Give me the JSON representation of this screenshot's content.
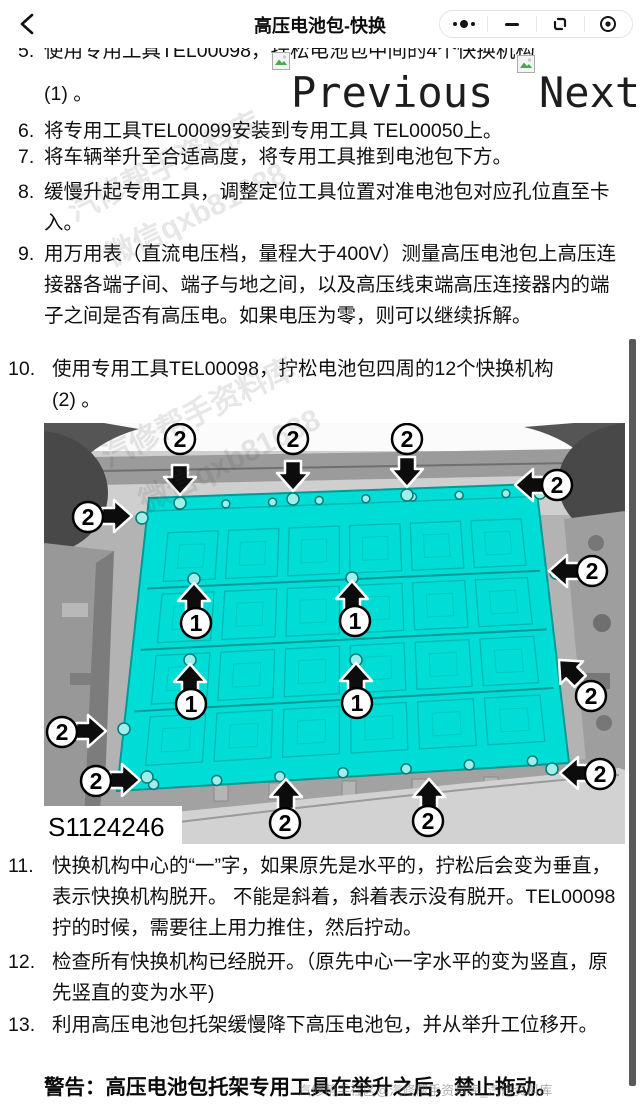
{
  "header": {
    "title": "高压电池包-快换",
    "back_icon": "chevron-left",
    "capsule_icons": [
      "more-dots",
      "minimize",
      "restore-window",
      "circle-dot-close"
    ]
  },
  "pager": {
    "previous_label": "Previous",
    "next_label": "Next",
    "icon": "broken-image"
  },
  "steps": [
    {
      "num": "5.",
      "text": "使用专用工具TEL00098，拧松电池包中间的4个快换机构",
      "cont": "(1) 。"
    },
    {
      "num": "6.",
      "text": "将专用工具TEL00099安装到专用工具 TEL00050上。"
    },
    {
      "num": "7.",
      "text": "将车辆举升至合适高度，将专用工具推到电池包下方。"
    },
    {
      "num": "8.",
      "text": "缓慢升起专用工具，调整定位工具位置对准电池包对应孔位直至卡入。"
    },
    {
      "num": "9.",
      "text": "用万用表（直流电压档，量程大于400V）测量高压电池包上高压连接器各端子间、端子与地之间，以及高压线束端高压连接器内的端子之间是否有高压电。如果电压为零，则可以继续拆解。"
    },
    {
      "num": "10.",
      "text": "使用专用工具TEL00098，拧松电池包四周的12个快换机构",
      "cont": "(2) 。"
    },
    {
      "num": "11.",
      "text": "快换机构中心的“一”字，如果原先是水平的，拧松后会变为垂直，表示快换机构脱开。 不能是斜着，斜着表示没有脱开。TEL00098拧的时候，需要往上用力推住，然后拧动。"
    },
    {
      "num": "12.",
      "text": "检查所有快换机构已经脱开。（原先中心一字水平的变为竖直，原先竖直的变为水平)"
    },
    {
      "num": "13.",
      "text": "利用高压电池包托架缓慢降下高压电池包，并从举升工位移开。"
    }
  ],
  "warning": {
    "label": "警告：",
    "text": "高压电池包托架专用工具在举升之后，禁止拖动。"
  },
  "figure": {
    "code": "S1124246",
    "battery_color": "#00ddd6",
    "arrows": [
      {
        "label": "2",
        "dir": "down",
        "tip": [
          136,
          72
        ],
        "badge": [
          136,
          16
        ]
      },
      {
        "label": "2",
        "dir": "down",
        "tip": [
          249,
          68
        ],
        "badge": [
          249,
          16
        ]
      },
      {
        "label": "2",
        "dir": "down",
        "tip": [
          363,
          64
        ],
        "badge": [
          363,
          16
        ]
      },
      {
        "label": "2",
        "dir": "left",
        "tip": [
          471,
          62
        ],
        "badge": [
          513,
          62
        ]
      },
      {
        "label": "2",
        "dir": "right",
        "tip": [
          88,
          93
        ],
        "badge": [
          44,
          94
        ]
      },
      {
        "label": "2",
        "dir": "left",
        "tip": [
          505,
          148
        ],
        "badge": [
          548,
          148
        ]
      },
      {
        "label": "1",
        "dir": "up",
        "tip": [
          150,
          160
        ],
        "badge": [
          152,
          200
        ]
      },
      {
        "label": "1",
        "dir": "up",
        "tip": [
          308,
          158
        ],
        "badge": [
          311,
          198
        ]
      },
      {
        "label": "1",
        "dir": "up",
        "tip": [
          146,
          241
        ],
        "badge": [
          147,
          281
        ]
      },
      {
        "label": "1",
        "dir": "up",
        "tip": [
          312,
          240
        ],
        "badge": [
          313,
          280
        ]
      },
      {
        "label": "2",
        "dir": "up-left",
        "tip": [
          515,
          237
        ],
        "badge": [
          547,
          273
        ]
      },
      {
        "label": "2",
        "dir": "right",
        "tip": [
          62,
          308
        ],
        "badge": [
          18,
          309
        ]
      },
      {
        "label": "2",
        "dir": "right",
        "tip": [
          96,
          357
        ],
        "badge": [
          52,
          358
        ]
      },
      {
        "label": "2",
        "dir": "left",
        "tip": [
          516,
          350
        ],
        "badge": [
          556,
          351
        ]
      },
      {
        "label": "2",
        "dir": "up",
        "tip": [
          242,
          356
        ],
        "badge": [
          241,
          400
        ]
      },
      {
        "label": "2",
        "dir": "up",
        "tip": [
          385,
          356
        ],
        "badge": [
          384,
          398
        ]
      }
    ]
  },
  "watermarks": [
    "汽修帮手资料库",
    "微信qxb81688",
    "汽修帮手资料库",
    "微信qxb81688",
    "汽修帮手社区@汽修帮手资料库_汽修资料库"
  ]
}
